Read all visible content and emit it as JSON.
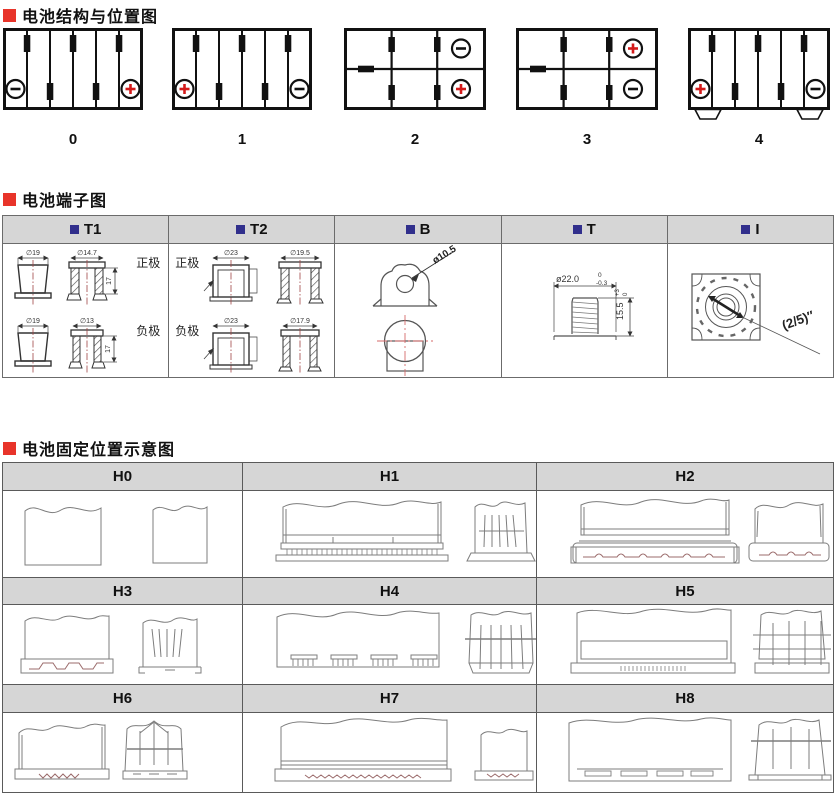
{
  "colors": {
    "accent_red": "#e8342a",
    "header_square_navy": "#312f8c",
    "table_header_bg": "#d6d6d6",
    "plus_symbol_red": "#d31a1a",
    "line_black": "#111111",
    "drawing_gray": "#7d7d7d"
  },
  "sections": {
    "structure": {
      "title": "电池结构与位置图",
      "figures": [
        {
          "label": "0"
        },
        {
          "label": "1"
        },
        {
          "label": "2"
        },
        {
          "label": "3"
        },
        {
          "label": "4"
        }
      ]
    },
    "terminals": {
      "title": "电池端子图",
      "columns": [
        {
          "label": "T1",
          "rows": [
            {
              "pole": "正极",
              "dim_a": "∅19",
              "dim_b": "∅14.7",
              "dim_h": "17"
            },
            {
              "pole": "负极",
              "dim_a": "∅19",
              "dim_b": "∅13",
              "dim_h": "17"
            }
          ]
        },
        {
          "label": "T2",
          "rows": [
            {
              "pole": "正极",
              "dim_a": "∅23",
              "dim_b": "∅19.5"
            },
            {
              "pole": "负极",
              "dim_a": "∅23",
              "dim_b": "∅17.9"
            }
          ]
        },
        {
          "label": "B",
          "dim": "ø10.5"
        },
        {
          "label": "T",
          "dia": "ø22.0",
          "dia_tol_top": "0",
          "dia_tol_bottom": "-0.3",
          "height": "15.5",
          "height_tol_top": "+3",
          "height_tol_bottom": "0"
        },
        {
          "label": "I",
          "dim": "(2/5)″"
        }
      ]
    },
    "holddown": {
      "title": "电池固定位置示意图",
      "cells": [
        {
          "label": "H0"
        },
        {
          "label": "H1"
        },
        {
          "label": "H2"
        },
        {
          "label": "H3"
        },
        {
          "label": "H4"
        },
        {
          "label": "H5"
        },
        {
          "label": "H6"
        },
        {
          "label": "H7"
        },
        {
          "label": "H8"
        }
      ]
    }
  }
}
